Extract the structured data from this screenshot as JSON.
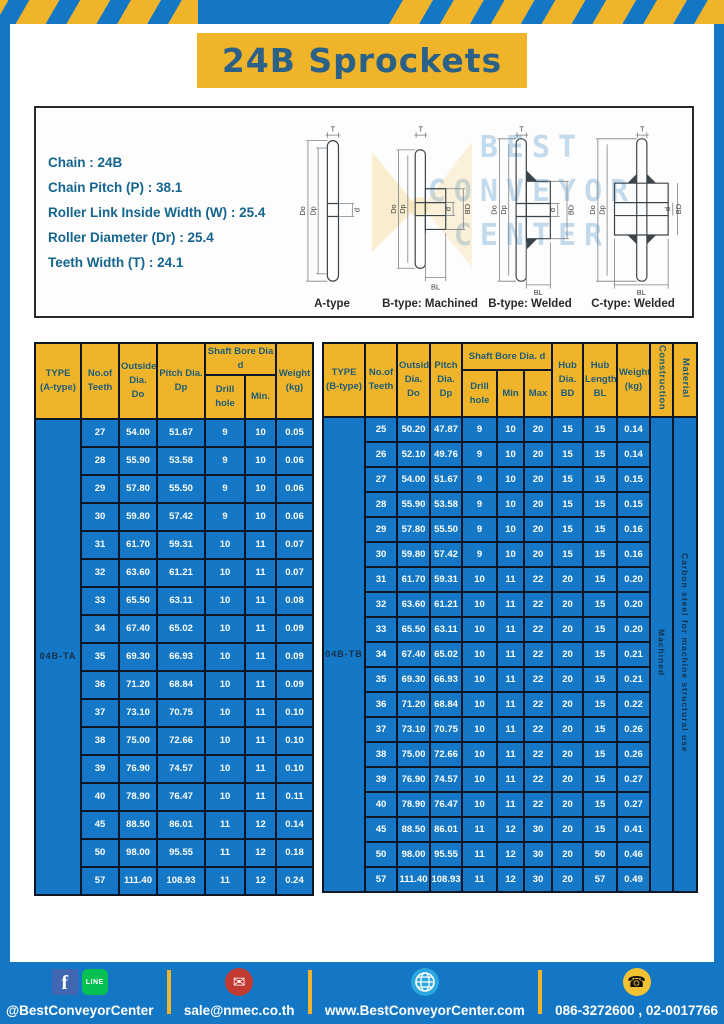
{
  "page": {
    "title": "24B Sprockets"
  },
  "specs": {
    "lines": [
      "Chain : 24B",
      "Chain Pitch (P) : 38.1",
      "Roller Link Inside Width (W) : 25.4",
      "Roller Diameter (Dr) : 25.4",
      "Teeth Width (T) : 24.1"
    ]
  },
  "watermark": {
    "line1": "BEST",
    "line2": "CONVEYOR",
    "line3": "CENTER"
  },
  "diagrams": {
    "dims": {
      "t": "T",
      "do": "Do",
      "dp": "Dp",
      "d": "d",
      "bd": "BD",
      "bl": "BL"
    },
    "captions": [
      "A-type",
      "B-type: Machined",
      "B-type: Welded",
      "C-type: Welded"
    ]
  },
  "table_a": {
    "headers": {
      "type": "TYPE\n(A-type)",
      "teeth": "No.of\nTeeth",
      "outside": "Outside\nDia.\nDo",
      "pitch": "Pitch Dia.\nDp",
      "shaft": "Shaft Bore Dia d",
      "drill": "Drill hole",
      "min": "Min.",
      "weight": "Weight\n(kg)"
    },
    "type_label": "04B-TA",
    "rows": [
      [
        "27",
        "54.00",
        "51.67",
        "9",
        "10",
        "0.05"
      ],
      [
        "28",
        "55.90",
        "53.58",
        "9",
        "10",
        "0.06"
      ],
      [
        "29",
        "57.80",
        "55.50",
        "9",
        "10",
        "0.06"
      ],
      [
        "30",
        "59.80",
        "57.42",
        "9",
        "10",
        "0.06"
      ],
      [
        "31",
        "61.70",
        "59.31",
        "10",
        "11",
        "0.07"
      ],
      [
        "32",
        "63.60",
        "61.21",
        "10",
        "11",
        "0.07"
      ],
      [
        "33",
        "65.50",
        "63.11",
        "10",
        "11",
        "0.08"
      ],
      [
        "34",
        "67.40",
        "65.02",
        "10",
        "11",
        "0.09"
      ],
      [
        "35",
        "69.30",
        "66.93",
        "10",
        "11",
        "0.09"
      ],
      [
        "36",
        "71.20",
        "68.84",
        "10",
        "11",
        "0.09"
      ],
      [
        "37",
        "73.10",
        "70.75",
        "10",
        "11",
        "0.10"
      ],
      [
        "38",
        "75.00",
        "72.66",
        "10",
        "11",
        "0.10"
      ],
      [
        "39",
        "76.90",
        "74.57",
        "10",
        "11",
        "0.10"
      ],
      [
        "40",
        "78.90",
        "76.47",
        "10",
        "11",
        "0.11"
      ],
      [
        "45",
        "88.50",
        "86.01",
        "11",
        "12",
        "0.14"
      ],
      [
        "50",
        "98.00",
        "95.55",
        "11",
        "12",
        "0.18"
      ],
      [
        "57",
        "111.40",
        "108.93",
        "11",
        "12",
        "0.24"
      ]
    ]
  },
  "table_b": {
    "headers": {
      "type": "TYPE\n(B-type)",
      "teeth": "No.of\nTeeth",
      "outside": "Outside\nDia.\nDo",
      "pitch": "Pitch\nDia.\nDp",
      "shaft": "Shaft Bore Dia.  d",
      "drill": "Drill hole",
      "min": "Min",
      "max": "Max",
      "hub_dia": "Hub\nDia.\nBD",
      "hub_len": "Hub\nLength\nBL",
      "weight": "Weight\n(kg)",
      "construction": "Construction",
      "material": "Material"
    },
    "type_label": "04B-TB",
    "construction_value": "Machined",
    "material_value": "Carbon steel for machine structural use",
    "rows": [
      [
        "25",
        "50.20",
        "47.87",
        "9",
        "10",
        "20",
        "15",
        "15",
        "0.14"
      ],
      [
        "26",
        "52.10",
        "49.76",
        "9",
        "10",
        "20",
        "15",
        "15",
        "0.14"
      ],
      [
        "27",
        "54.00",
        "51.67",
        "9",
        "10",
        "20",
        "15",
        "15",
        "0.15"
      ],
      [
        "28",
        "55.90",
        "53.58",
        "9",
        "10",
        "20",
        "15",
        "15",
        "0.15"
      ],
      [
        "29",
        "57.80",
        "55.50",
        "9",
        "10",
        "20",
        "15",
        "15",
        "0.16"
      ],
      [
        "30",
        "59.80",
        "57.42",
        "9",
        "10",
        "20",
        "15",
        "15",
        "0.16"
      ],
      [
        "31",
        "61.70",
        "59.31",
        "10",
        "11",
        "22",
        "20",
        "15",
        "0.20"
      ],
      [
        "32",
        "63.60",
        "61.21",
        "10",
        "11",
        "22",
        "20",
        "15",
        "0.20"
      ],
      [
        "33",
        "65.50",
        "63.11",
        "10",
        "11",
        "22",
        "20",
        "15",
        "0.20"
      ],
      [
        "34",
        "67.40",
        "65.02",
        "10",
        "11",
        "22",
        "20",
        "15",
        "0.21"
      ],
      [
        "35",
        "69.30",
        "66.93",
        "10",
        "11",
        "22",
        "20",
        "15",
        "0.21"
      ],
      [
        "36",
        "71.20",
        "68.84",
        "10",
        "11",
        "22",
        "20",
        "15",
        "0.22"
      ],
      [
        "37",
        "73.10",
        "70.75",
        "10",
        "11",
        "22",
        "20",
        "15",
        "0.26"
      ],
      [
        "38",
        "75.00",
        "72.66",
        "10",
        "11",
        "22",
        "20",
        "15",
        "0.26"
      ],
      [
        "39",
        "76.90",
        "74.57",
        "10",
        "11",
        "22",
        "20",
        "15",
        "0.27"
      ],
      [
        "40",
        "78.90",
        "76.47",
        "10",
        "11",
        "22",
        "20",
        "15",
        "0.27"
      ],
      [
        "45",
        "88.50",
        "86.01",
        "11",
        "12",
        "30",
        "20",
        "15",
        "0.41"
      ],
      [
        "50",
        "98.00",
        "95.55",
        "11",
        "12",
        "30",
        "20",
        "50",
        "0.46"
      ],
      [
        "57",
        "111.40",
        "108.93",
        "11",
        "12",
        "30",
        "20",
        "57",
        "0.49"
      ]
    ]
  },
  "footer": {
    "fb_letter": "f",
    "line_text": "LINE",
    "social_label": "@BestConveyorCenter",
    "email_label": "sale@nmec.co.th",
    "website_label": "www.BestConveyorCenter.com",
    "phone_label": "086-3272600 , 02-0017766",
    "mail_glyph": "✉",
    "phone_glyph": "☎"
  },
  "colors": {
    "blue": "#1377c5",
    "cell-blue": "#1478c6",
    "yellow": "#f0b42a",
    "title-text": "#2b6187",
    "header-text": "#1d5c77",
    "spec-text": "#15658e",
    "border-dark": "#0d1626",
    "dark-label": "#16304a"
  }
}
